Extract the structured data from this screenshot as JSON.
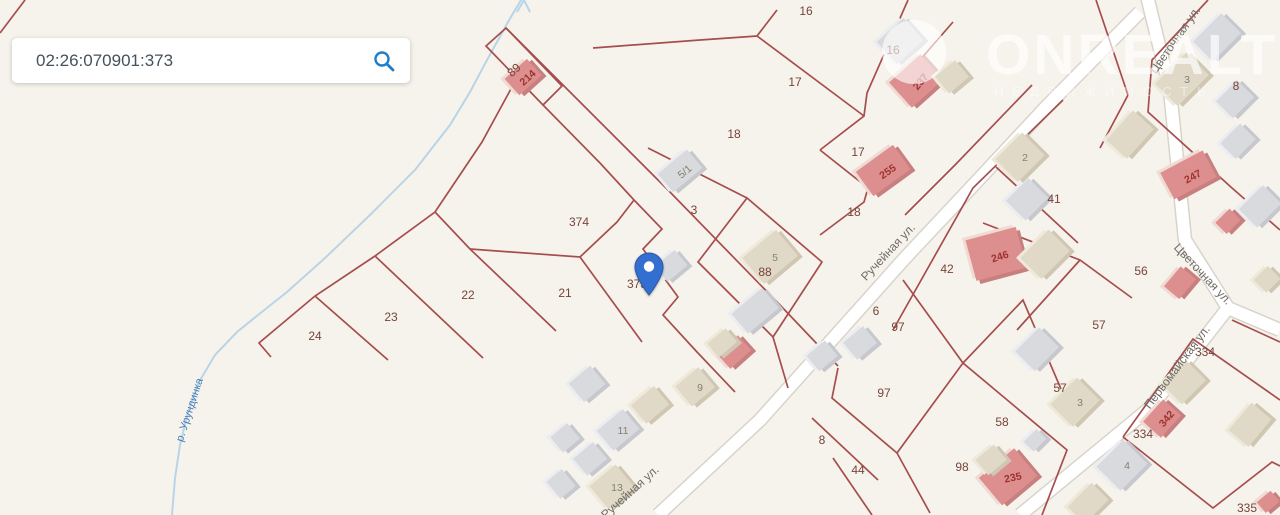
{
  "search": {
    "value": "02:26:070901:373"
  },
  "watermark": {
    "brand": "ONREALT",
    "tagline": "НЕДВИЖИМОСТЬ"
  },
  "colors": {
    "background": "#f6f3ec",
    "parcel_line": "#a04040",
    "road_fill": "#ffffff",
    "road_casing": "#d8d4cb",
    "river": "#b9d4e6",
    "river_label": "#4a80ba",
    "parcel_label": "#76443b",
    "street_label": "#6f6b66",
    "pin": "#336fd0",
    "search_icon": "#1e7ec9",
    "building_pink": "#dd8f8f",
    "building_gray": "#d9dadd",
    "building_beige": "#e0d9c8"
  },
  "map": {
    "river_label": {
      "text": "р. Урундинка",
      "x": 190,
      "y": 410,
      "rot": -72
    },
    "street_labels": [
      {
        "text": "Ручейная ул.",
        "x": 888,
        "y": 252,
        "rot": -47
      },
      {
        "text": "Ручейная ул.",
        "x": 630,
        "y": 492,
        "rot": -42
      },
      {
        "text": "Цветочная ул.",
        "x": 1175,
        "y": 40,
        "rot": -55
      },
      {
        "text": "Цветочная ул.",
        "x": 1203,
        "y": 274,
        "rot": 47
      },
      {
        "text": "Первомайская ул.",
        "x": 1177,
        "y": 367,
        "rot": -53
      }
    ],
    "parcel_labels": [
      {
        "text": "16",
        "x": 806,
        "y": 11
      },
      {
        "text": "16",
        "x": 893,
        "y": 50
      },
      {
        "text": "17",
        "x": 795,
        "y": 82
      },
      {
        "text": "17",
        "x": 858,
        "y": 152
      },
      {
        "text": "18",
        "x": 734,
        "y": 134
      },
      {
        "text": "18",
        "x": 854,
        "y": 212
      },
      {
        "text": "8",
        "x": 1236,
        "y": 86
      },
      {
        "text": "3",
        "x": 694,
        "y": 210
      },
      {
        "text": "374",
        "x": 579,
        "y": 222
      },
      {
        "text": "373",
        "x": 637,
        "y": 284
      },
      {
        "text": "21",
        "x": 565,
        "y": 293
      },
      {
        "text": "22",
        "x": 468,
        "y": 295
      },
      {
        "text": "23",
        "x": 391,
        "y": 317
      },
      {
        "text": "24",
        "x": 315,
        "y": 336
      },
      {
        "text": "89",
        "x": 514,
        "y": 70,
        "rot": -42
      },
      {
        "text": "88",
        "x": 765,
        "y": 272
      },
      {
        "text": "41",
        "x": 1054,
        "y": 199
      },
      {
        "text": "42",
        "x": 947,
        "y": 269
      },
      {
        "text": "56",
        "x": 1141,
        "y": 271
      },
      {
        "text": "57",
        "x": 1099,
        "y": 325
      },
      {
        "text": "57",
        "x": 1060,
        "y": 388
      },
      {
        "text": "58",
        "x": 1002,
        "y": 422
      },
      {
        "text": "6",
        "x": 876,
        "y": 311
      },
      {
        "text": "97",
        "x": 898,
        "y": 327
      },
      {
        "text": "97",
        "x": 884,
        "y": 393
      },
      {
        "text": "8",
        "x": 822,
        "y": 440
      },
      {
        "text": "44",
        "x": 858,
        "y": 470
      },
      {
        "text": "98",
        "x": 962,
        "y": 467
      },
      {
        "text": "334",
        "x": 1205,
        "y": 352
      },
      {
        "text": "334",
        "x": 1143,
        "y": 434
      },
      {
        "text": "335",
        "x": 1247,
        "y": 508
      }
    ],
    "buildings": [
      {
        "type": "pink",
        "x": 528,
        "y": 78,
        "w": 30,
        "h": 22,
        "rot": -42,
        "num": "214",
        "num_rot": -42
      },
      {
        "type": "pink",
        "x": 921,
        "y": 82,
        "w": 42,
        "h": 34,
        "rot": -42,
        "num": "237",
        "num_rot": -50
      },
      {
        "type": "pink",
        "x": 888,
        "y": 172,
        "w": 46,
        "h": 30,
        "rot": -36,
        "num": "255",
        "num_rot": -35
      },
      {
        "type": "pink",
        "x": 1193,
        "y": 177,
        "w": 48,
        "h": 30,
        "rot": -28,
        "num": "247",
        "num_rot": -28
      },
      {
        "type": "pink",
        "x": 1000,
        "y": 257,
        "w": 52,
        "h": 42,
        "rot": -15,
        "num": "246",
        "num_rot": -18
      },
      {
        "type": "pink",
        "x": 1167,
        "y": 419,
        "w": 30,
        "h": 24,
        "rot": -48,
        "num": "342",
        "num_rot": -50
      },
      {
        "type": "pink",
        "x": 1013,
        "y": 478,
        "w": 46,
        "h": 36,
        "rot": -40,
        "num": "235",
        "num_rot": -12
      },
      {
        "type": "pink",
        "x": 1233,
        "y": 222,
        "w": 20,
        "h": 16,
        "rot": -45
      },
      {
        "type": "pink",
        "x": 1185,
        "y": 283,
        "w": 26,
        "h": 20,
        "rot": -50
      },
      {
        "type": "pink",
        "x": 739,
        "y": 353,
        "w": 28,
        "h": 20,
        "rot": -42
      },
      {
        "type": "pink",
        "x": 1273,
        "y": 503,
        "w": 18,
        "h": 14,
        "rot": -40
      },
      {
        "type": "gray",
        "x": 685,
        "y": 172,
        "w": 38,
        "h": 24,
        "rot": -40,
        "num": "5/1",
        "num_rot": -40
      },
      {
        "type": "gray",
        "x": 676,
        "y": 267,
        "w": 26,
        "h": 20,
        "rot": -40
      },
      {
        "type": "gray",
        "x": 760,
        "y": 312,
        "w": 40,
        "h": 26,
        "rot": -40
      },
      {
        "type": "gray",
        "x": 592,
        "y": 385,
        "w": 28,
        "h": 24,
        "rot": -40
      },
      {
        "type": "gray",
        "x": 623,
        "y": 431,
        "w": 34,
        "h": 26,
        "rot": -40,
        "num": "11",
        "num_rot": 0
      },
      {
        "type": "gray",
        "x": 570,
        "y": 439,
        "w": 22,
        "h": 20,
        "rot": -40
      },
      {
        "type": "gray",
        "x": 595,
        "y": 460,
        "w": 26,
        "h": 22,
        "rot": -40
      },
      {
        "type": "gray",
        "x": 566,
        "y": 485,
        "w": 20,
        "h": 22,
        "rot": -40
      },
      {
        "type": "gray",
        "x": 827,
        "y": 357,
        "w": 24,
        "h": 20,
        "rot": -40
      },
      {
        "type": "gray",
        "x": 865,
        "y": 344,
        "w": 26,
        "h": 22,
        "rot": -40
      },
      {
        "type": "gray",
        "x": 1032,
        "y": 200,
        "w": 32,
        "h": 28,
        "rot": -45
      },
      {
        "type": "gray",
        "x": 1042,
        "y": 350,
        "w": 34,
        "h": 28,
        "rot": -45
      },
      {
        "type": "gray",
        "x": 1127,
        "y": 466,
        "w": 38,
        "h": 34,
        "rot": -45,
        "num": "4",
        "num_rot": 0
      },
      {
        "type": "gray",
        "x": 1040,
        "y": 441,
        "w": 18,
        "h": 14,
        "rot": -45
      },
      {
        "type": "gray",
        "x": 905,
        "y": 42,
        "w": 36,
        "h": 30,
        "rot": -42
      },
      {
        "type": "gray",
        "x": 1222,
        "y": 38,
        "w": 40,
        "h": 28,
        "rot": -45
      },
      {
        "type": "gray",
        "x": 1240,
        "y": 100,
        "w": 30,
        "h": 24,
        "rot": -45
      },
      {
        "type": "gray",
        "x": 1243,
        "y": 142,
        "w": 28,
        "h": 22,
        "rot": -45
      },
      {
        "type": "gray",
        "x": 1265,
        "y": 207,
        "w": 34,
        "h": 26,
        "rot": -45
      },
      {
        "type": "beige",
        "x": 700,
        "y": 388,
        "w": 30,
        "h": 26,
        "rot": -40,
        "num": "9",
        "num_rot": 0
      },
      {
        "type": "beige",
        "x": 617,
        "y": 488,
        "w": 34,
        "h": 30,
        "rot": -40,
        "num": "13",
        "num_rot": 0
      },
      {
        "type": "beige",
        "x": 655,
        "y": 406,
        "w": 30,
        "h": 24,
        "rot": -40
      },
      {
        "type": "beige",
        "x": 957,
        "y": 78,
        "w": 26,
        "h": 22,
        "rot": -40
      },
      {
        "type": "beige",
        "x": 1025,
        "y": 158,
        "w": 38,
        "h": 32,
        "rot": -45,
        "num": "2",
        "num_rot": 0
      },
      {
        "type": "beige",
        "x": 1050,
        "y": 255,
        "w": 40,
        "h": 30,
        "rot": -45
      },
      {
        "type": "beige",
        "x": 1080,
        "y": 403,
        "w": 38,
        "h": 32,
        "rot": -45,
        "num": "3",
        "num_rot": 0
      },
      {
        "type": "beige",
        "x": 1272,
        "y": 280,
        "w": 20,
        "h": 18,
        "rot": -45
      },
      {
        "type": "beige",
        "x": 1135,
        "y": 135,
        "w": 40,
        "h": 28,
        "rot": -48
      },
      {
        "type": "beige",
        "x": 1189,
        "y": 383,
        "w": 34,
        "h": 28,
        "rot": -45
      },
      {
        "type": "beige",
        "x": 1093,
        "y": 504,
        "w": 34,
        "h": 24,
        "rot": -45
      },
      {
        "type": "beige",
        "x": 775,
        "y": 258,
        "w": 44,
        "h": 34,
        "rot": -40,
        "num": "5",
        "num_rot": 0
      },
      {
        "type": "beige",
        "x": 996,
        "y": 461,
        "w": 24,
        "h": 20,
        "rot": -40
      },
      {
        "type": "beige",
        "x": 727,
        "y": 344,
        "w": 24,
        "h": 18,
        "rot": -40
      },
      {
        "type": "beige",
        "x": 1187,
        "y": 80,
        "w": 44,
        "h": 32,
        "rot": -45,
        "num": "3",
        "num_rot": 0
      },
      {
        "type": "beige",
        "x": 1255,
        "y": 425,
        "w": 36,
        "h": 26,
        "rot": -50
      }
    ],
    "pin": {
      "x": 649,
      "y": 296
    }
  }
}
